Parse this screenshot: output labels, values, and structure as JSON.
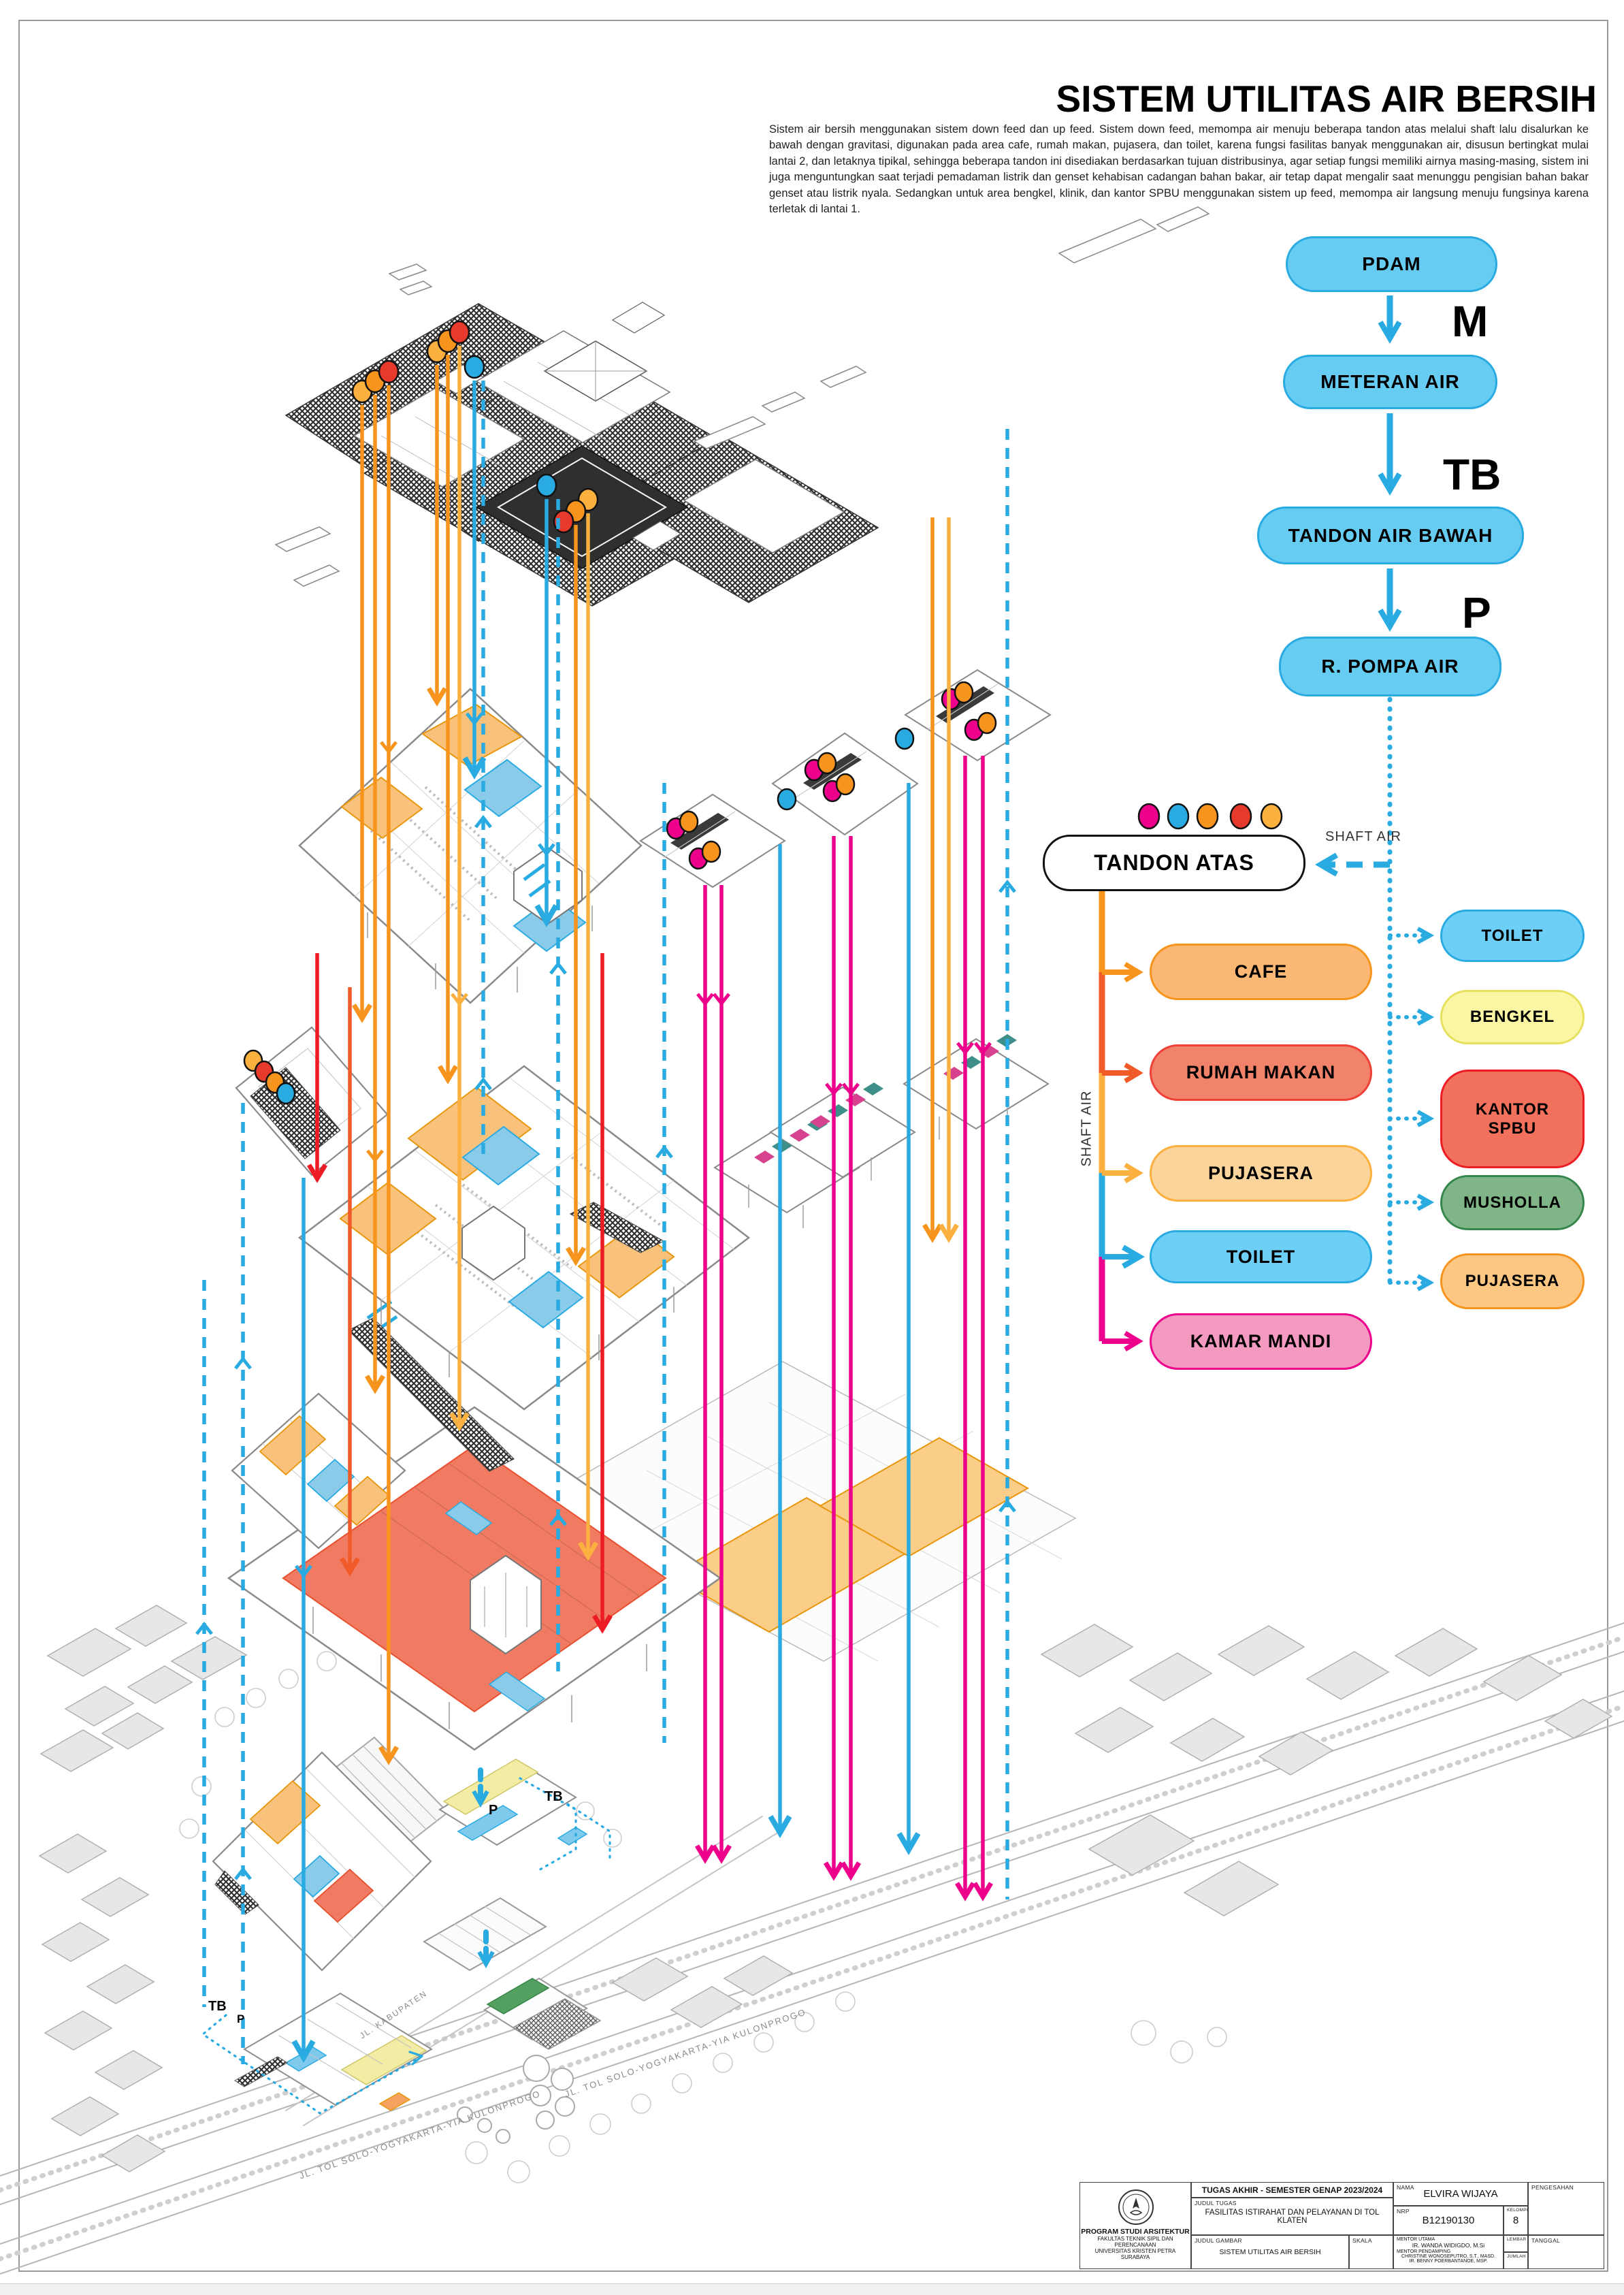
{
  "title": "SISTEM UTILITAS AIR BERSIH",
  "intro": "Sistem air bersih menggunakan sistem down feed dan up feed. Sistem down feed, memompa air menuju beberapa tandon atas melalui shaft lalu disalurkan ke bawah dengan gravitasi, digunakan pada area cafe, rumah makan, pujasera, dan toilet, karena fungsi fasilitas banyak menggunakan air, disusun bertingkat mulai lantai 2, dan letaknya tipikal, sehingga beberapa tandon ini disediakan berdasarkan tujuan distribusinya, agar setiap fungsi memiliki airnya masing-masing, sistem ini juga menguntungkan saat terjadi pemadaman listrik dan genset kehabisan cadangan bahan bakar, air tetap dapat mengalir saat menunggu pengisian bahan bakar genset atau listrik nyala. Sedangkan untuk area bengkel, klinik, dan kantor SPBU menggunakan sistem up feed, memompa air langsung menuju fungsinya karena  terletak di lantai 1.",
  "flow": {
    "pdam": "PDAM",
    "m": "M",
    "meteran": "METERAN AIR",
    "tb": "TB",
    "tandon_bawah": "TANDON AIR BAWAH",
    "p": "P",
    "pompa": "R. POMPA AIR",
    "shaft_air": "SHAFT AIR",
    "tandon_atas": "TANDON ATAS",
    "down_feed": [
      "CAFE",
      "RUMAH MAKAN",
      "PUJASERA",
      "TOILET",
      "KAMAR MANDI"
    ],
    "up_feed": [
      "TOILET",
      "BENGKEL",
      "KANTOR SPBU",
      "MUSHOLLA",
      "PUJASERA"
    ]
  },
  "site": {
    "tb": "TB",
    "p": "P",
    "road_toll": "JL. TOL SOLO-YOGYAKARTA-YIA KULONPROGO",
    "road_kabupaten": "JL. KABUPATEN"
  },
  "titleblock": {
    "header": "TUGAS AKHIR - SEMESTER GENAP 2023/2024",
    "judul_tugas_label": "JUDUL TUGAS",
    "judul_tugas": "FASILITAS ISTIRAHAT DAN PELAYANAN DI TOL KLATEN",
    "judul_gambar_label": "JUDUL GAMBAR",
    "judul_gambar": "SISTEM UTILITAS AIR BERSIH",
    "skala_label": "SKALA",
    "nama_label": "NAMA",
    "nama": "ELVIRA WIJAYA",
    "nrp_label": "NRP",
    "nrp": "B12190130",
    "kelompok_label": "KELOMPOK",
    "kelompok": "8",
    "mentor_utama_label": "MENTOR UTAMA",
    "mentor_utama": "IR. WANDA WIDIGDO, M.Si",
    "mentor_pendamping_label": "MENTOR PENDAMPING",
    "mentor_pendamping_1": "CHRISTINE WONOSEPUTRO, S.T., MASD.",
    "mentor_pendamping_2": "IR. BENNY POERBANTANOE, MSP.",
    "lembar_label": "LEMBAR",
    "jumlah_label": "JUMLAH",
    "pengesahan_label": "PENGESAHAN",
    "tanggal_label": "TANGGAL",
    "institusi_1": "PROGRAM STUDI ARSITEKTUR",
    "institusi_2": "FAKULTAS TEKNIK SIPIL DAN PERENCANAAN",
    "institusi_3": "UNIVERSITAS KRISTEN PETRA",
    "institusi_4": "SURABAYA"
  },
  "colors": {
    "blue": "#29ABE2",
    "blue_fill": "#66CCF2",
    "orange": "#F7941D",
    "amber": "#FBB040",
    "red_orange": "#F15A29",
    "red": "#ED1C24",
    "magenta": "#EC008C",
    "pink_fill": "#F49AC1",
    "salmon_fill": "#F2836B",
    "yellow_fill": "#FAF6A3",
    "green_fill": "#7FB588",
    "legend_dots": [
      "#EC008C",
      "#29ABE2",
      "#F7941D",
      "#E8392D",
      "#FBB040"
    ]
  }
}
